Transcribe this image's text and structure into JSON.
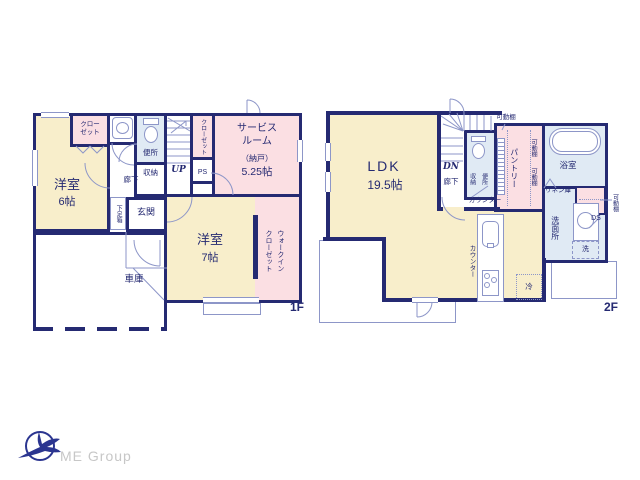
{
  "palette": {
    "wall": "#252a72",
    "text": "#252a72",
    "line": "#8d96c8",
    "cream": "#f8eecb",
    "pink": "#fbdfe3",
    "blue": "#e0eaf4",
    "logo-navy": "#2b3590",
    "logo-gray": "#c7c7c7"
  },
  "floor1": {
    "tag": "1F",
    "labels": {
      "closet_nw": "クロー\nゼット",
      "room6_name": "洋室",
      "room6_size": "6帖",
      "toilet": "便所",
      "storage": "収納",
      "up": "UP",
      "corridor": "廊下",
      "closet_east": "クローゼット",
      "ps": "PS",
      "service_name": "サービス\nルーム",
      "service_note": "（納戸）",
      "service_size": "5.25帖",
      "shoe_box": "下足箱",
      "entrance": "玄関",
      "garage": "車庫",
      "room7_name": "洋室",
      "room7_size": "7帖",
      "wic": "ウォークイン\nクローゼット"
    }
  },
  "floor2": {
    "tag": "2F",
    "labels": {
      "ldk": "LDK",
      "ldk_size": "19.5帖",
      "dn": "DN",
      "corridor": "廊下",
      "storage": "収納",
      "toilet": "便所",
      "counter_wall": "カウンター",
      "shelf_top": "可動棚",
      "pantry": "パントリー",
      "shelf_1": "可動棚",
      "shelf_2": "可動棚",
      "bath": "浴室",
      "linen": "リネン庫",
      "shelf_right": "可動棚",
      "washroom": "洗面所",
      "duct": "DS",
      "washer": "洗",
      "counter_kitchen": "カウンター",
      "fridge": "冷"
    }
  },
  "logo": {
    "text": "ME Group"
  }
}
